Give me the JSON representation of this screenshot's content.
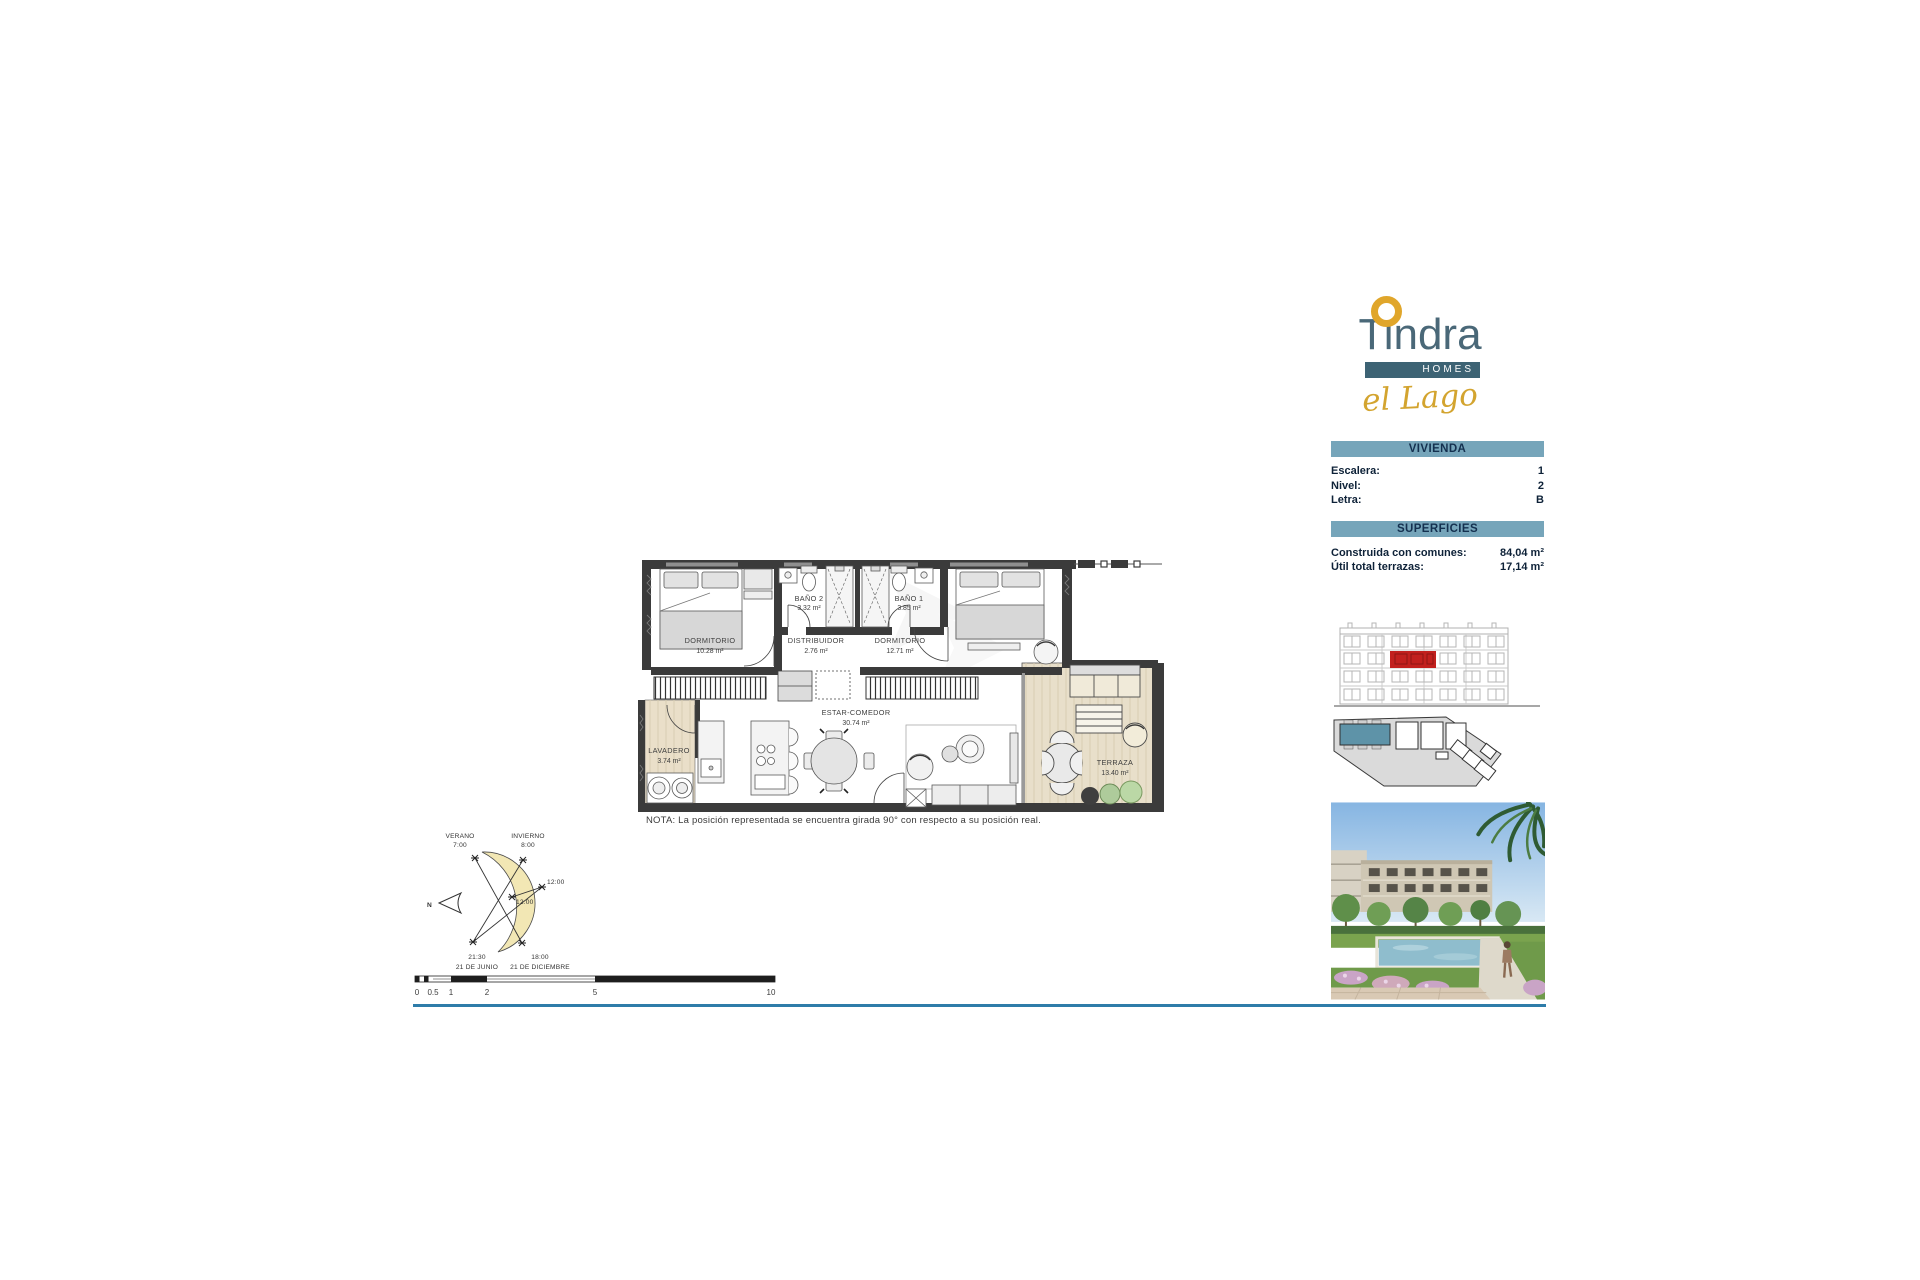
{
  "logo": {
    "brand": "Tindra",
    "homes": "HOMES",
    "collection": "el Lago"
  },
  "info": {
    "vivienda": {
      "title": "VIVIENDA",
      "rows": [
        {
          "label": "Escalera:",
          "value": "1"
        },
        {
          "label": "Nivel:",
          "value": "2"
        },
        {
          "label": "Letra:",
          "value": "B"
        }
      ]
    },
    "superficies": {
      "title": "SUPERFICIES",
      "rows": [
        {
          "label": "Construida con comunes:",
          "value": "84,04 m²"
        },
        {
          "label": "Útil total terrazas:",
          "value": "17,14 m²"
        }
      ]
    }
  },
  "plan": {
    "rooms": {
      "dormitorio1": {
        "name": "DORMITORIO",
        "area": "10.28 m²"
      },
      "bano2": {
        "name": "BAÑO 2",
        "area": "3.32 m²"
      },
      "bano1": {
        "name": "BAÑO 1",
        "area": "3.85 m²"
      },
      "distribuidor": {
        "name": "DISTRIBUIDOR",
        "area": "2.76 m²"
      },
      "dormitorio2": {
        "name": "DORMITORIO",
        "area": "12.71 m²"
      },
      "lavadero": {
        "name": "LAVADERO",
        "area": "3.74 m²"
      },
      "estar": {
        "name": "ESTAR-COMEDOR",
        "area": "30.74 m²"
      },
      "terraza": {
        "name": "TERRAZA",
        "area": "13.40 m²"
      }
    },
    "note": "NOTA: La posición representada se encuentra girada 90° con respecto a su posición real."
  },
  "sun": {
    "north": "N",
    "verano": "VERANO",
    "verano_start": "7:00",
    "invierno": "INVIERNO",
    "invierno_start": "8:00",
    "noon_right": "12:00",
    "noon_center": "12:00",
    "verano_end": "21:30",
    "verano_date": "21 DE JUNIO",
    "invierno_end": "18:00",
    "invierno_date": "21 DE DICIEMBRE"
  },
  "scale": {
    "t0": "0",
    "t05": "0.5",
    "t1": "1",
    "t2": "2",
    "t5": "5",
    "t10": "10"
  },
  "colors": {
    "accent_gold": "#E0A62B",
    "brand_slate": "#4A6878",
    "homes_bg": "#3D6374",
    "panel_header": "#76A5BA",
    "panel_text": "#0E2238",
    "highlight_red": "#C2201E",
    "site_teal": "#5E93A8",
    "separator_blue": "#2E7CA9",
    "deck_beige": "#E8DFCA",
    "wall_dark": "#3B3B3B"
  }
}
